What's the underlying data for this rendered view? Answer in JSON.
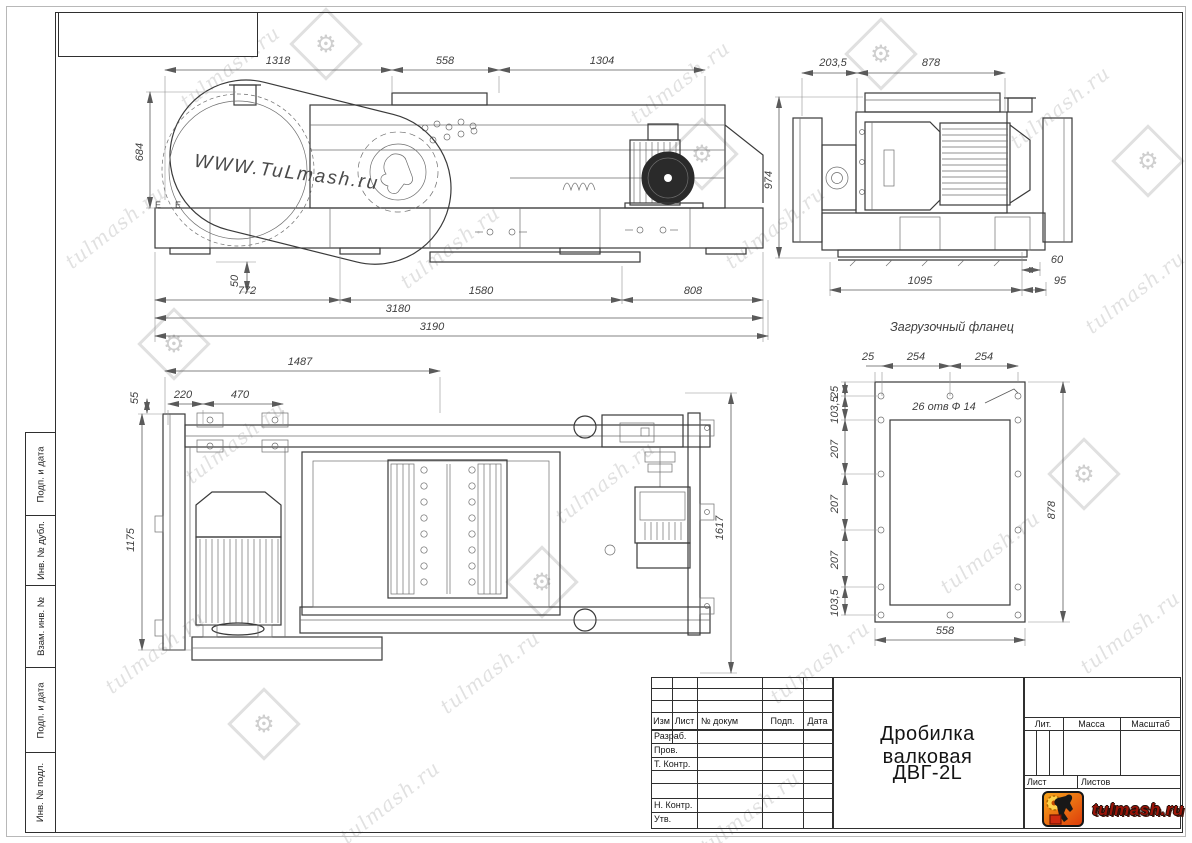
{
  "watermark": {
    "text": "tulmash.ru"
  },
  "views": {
    "side": {
      "guard_text": "WWW.TuLmash.ru",
      "label_e": "Е",
      "dims": {
        "d1318": "1318",
        "d558": "558",
        "d1304": "1304",
        "d684": "684",
        "d50": "50",
        "d772": "772",
        "d1580": "1580",
        "d808": "808",
        "d3180": "3180",
        "d3190": "3190"
      }
    },
    "end": {
      "dims": {
        "d203_5": "203,5",
        "d878": "878",
        "d974": "974",
        "d1095": "1095",
        "d60": "60",
        "d95": "95"
      }
    },
    "plan": {
      "dims": {
        "d1487": "1487",
        "d220": "220",
        "d470": "470",
        "d55": "55",
        "d1175": "1175",
        "d1617": "1617"
      }
    },
    "flange": {
      "title": "Загрузочный фланец",
      "note": "26 отв Ф 14",
      "dims": {
        "d25": "25",
        "d254": "254",
        "d103_5": "103,5",
        "d207": "207",
        "d878": "878",
        "d558": "558"
      }
    }
  },
  "side_strip": {
    "cells": [
      "Подп. и дата",
      "Инв. № дубл.",
      "Взам. инв. №",
      "Подп. и дата",
      "Инв. № подл."
    ]
  },
  "title_block": {
    "col_izm": "Изм",
    "col_list": "Лист",
    "col_doc": "№ докум",
    "col_podp": "Подп.",
    "col_data": "Дата",
    "role_razrab": "Разраб.",
    "role_prov": "Пров.",
    "role_tkontr": "Т. Контр.",
    "role_nkontr": "Н. Контр.",
    "role_utv": "Утв.",
    "title_line1": "Дробилка валковая",
    "title_line2": "ДВГ-2L",
    "lit": "Лит.",
    "massa": "Масса",
    "masshtab": "Масштаб",
    "list": "Лист",
    "listov": "Листов",
    "logo_text": "tulmash.ru"
  }
}
